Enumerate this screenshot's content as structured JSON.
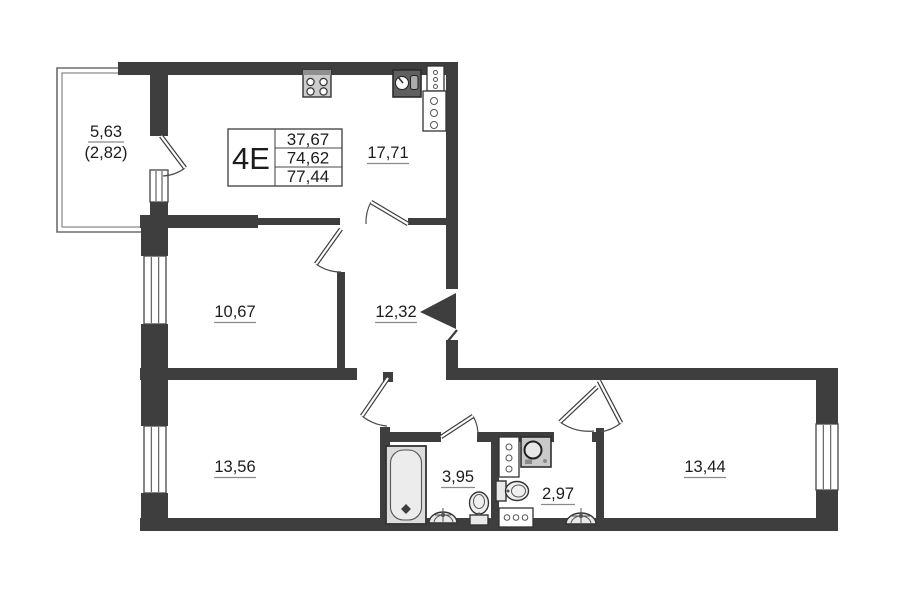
{
  "unit_card": {
    "unit": "4E",
    "living_area": "37,67",
    "apartment_area": "74,62",
    "total_area": "77,44"
  },
  "rooms": {
    "balcony": {
      "area": "5,63",
      "area_reduced": "(2,82)"
    },
    "kitchen_living": {
      "area": "17,71"
    },
    "bedroom_left": {
      "area": "10,67"
    },
    "hallway": {
      "area": "12,32"
    },
    "bedroom_bottom_left": {
      "area": "13,56"
    },
    "bathroom": {
      "area": "3,95"
    },
    "wc": {
      "area": "2,97"
    },
    "bedroom_bottom_right": {
      "area": "13,44"
    }
  },
  "fixtures": {
    "kitchen": [
      "stove-icon",
      "kitchen-sink-icon",
      "vent-shaft-icon"
    ],
    "bathroom": [
      "bathtub-icon",
      "wash-basin-icon",
      "toilet-icon"
    ],
    "wc": [
      "washing-machine-icon",
      "toilet-icon",
      "towel-dryer-icon",
      "wash-basin-icon",
      "vent-shaft-icon"
    ],
    "entrance": [
      "entrance-arrow-icon"
    ]
  },
  "colors": {
    "wall": "#3e3e3e",
    "line": "#4a4a4a",
    "fixture_fill": "#e9e9e9",
    "background": "#ffffff",
    "text": "#1c1c1c"
  }
}
